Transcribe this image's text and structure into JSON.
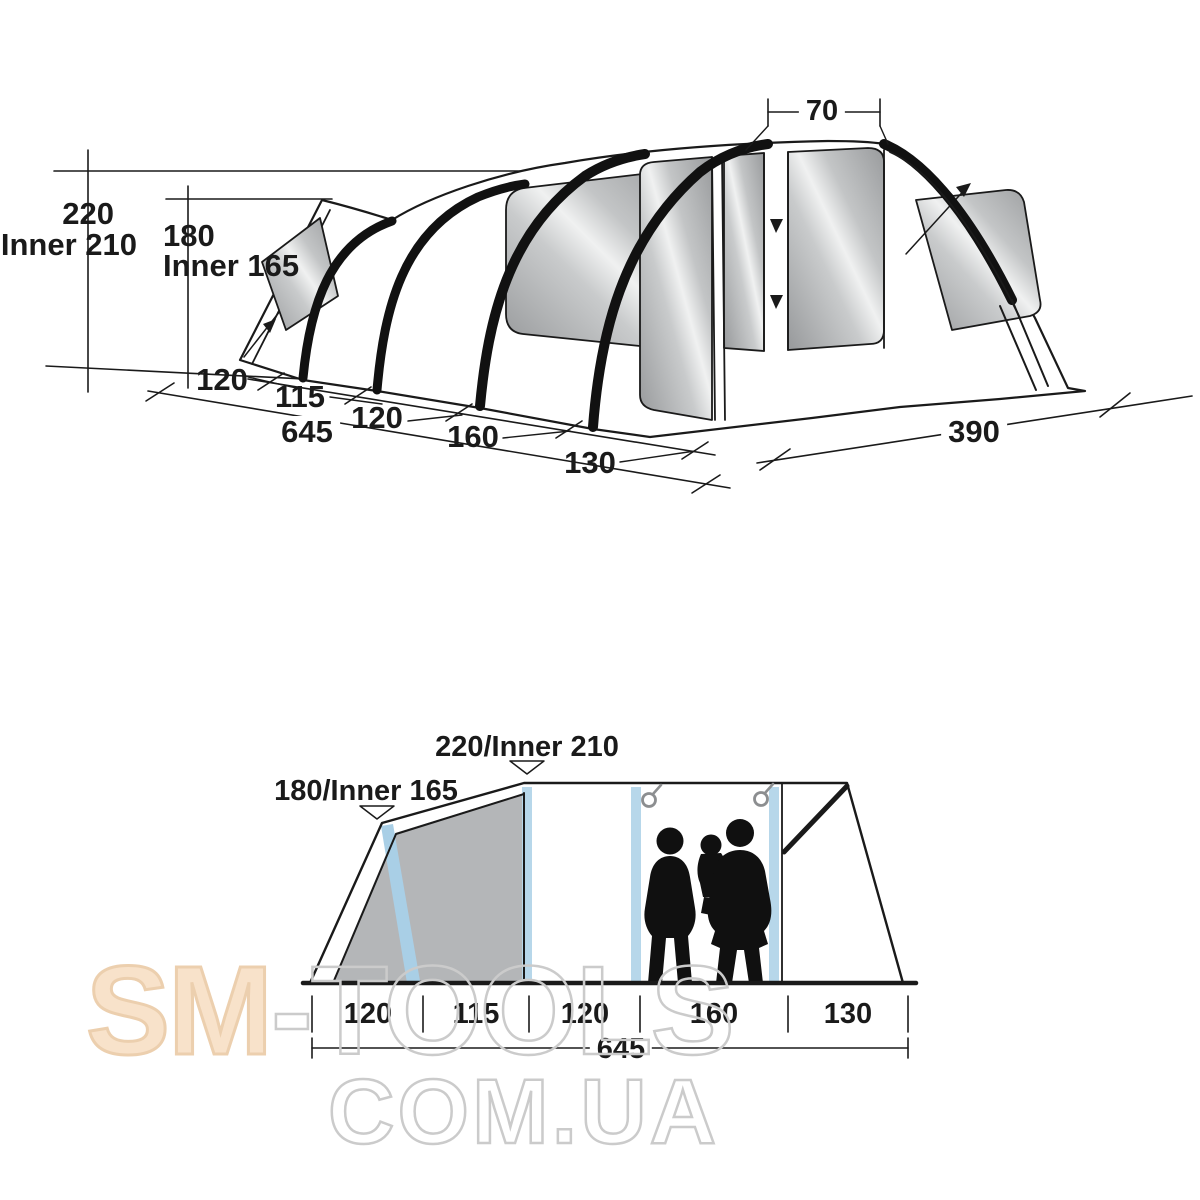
{
  "colors": {
    "line": "#1a1a1a",
    "window_gray": "#aeb0b2",
    "panel_gray": "#b4b6b8",
    "pole_blue": "#b7d7ea",
    "watermark_peach": "#f8e2ca",
    "watermark_outline": "#cbcbcb"
  },
  "watermark": {
    "brand_solid": "SM",
    "brand_outline": "-TOOLS",
    "domain_outline": "COM.UA"
  },
  "perspective_view": {
    "door_top_width": "70",
    "peak_height": "220",
    "peak_height_inner": "Inner 210",
    "rear_height": "180",
    "rear_height_inner": "Inner 165",
    "segments": [
      "120",
      "115",
      "120",
      "160",
      "130"
    ],
    "total_length": "645",
    "front_width": "390"
  },
  "side_view": {
    "peak_height": "220/Inner 210",
    "rear_height": "180/Inner 165",
    "segments": [
      "120",
      "115",
      "120",
      "160",
      "130"
    ],
    "total_length": "645"
  }
}
